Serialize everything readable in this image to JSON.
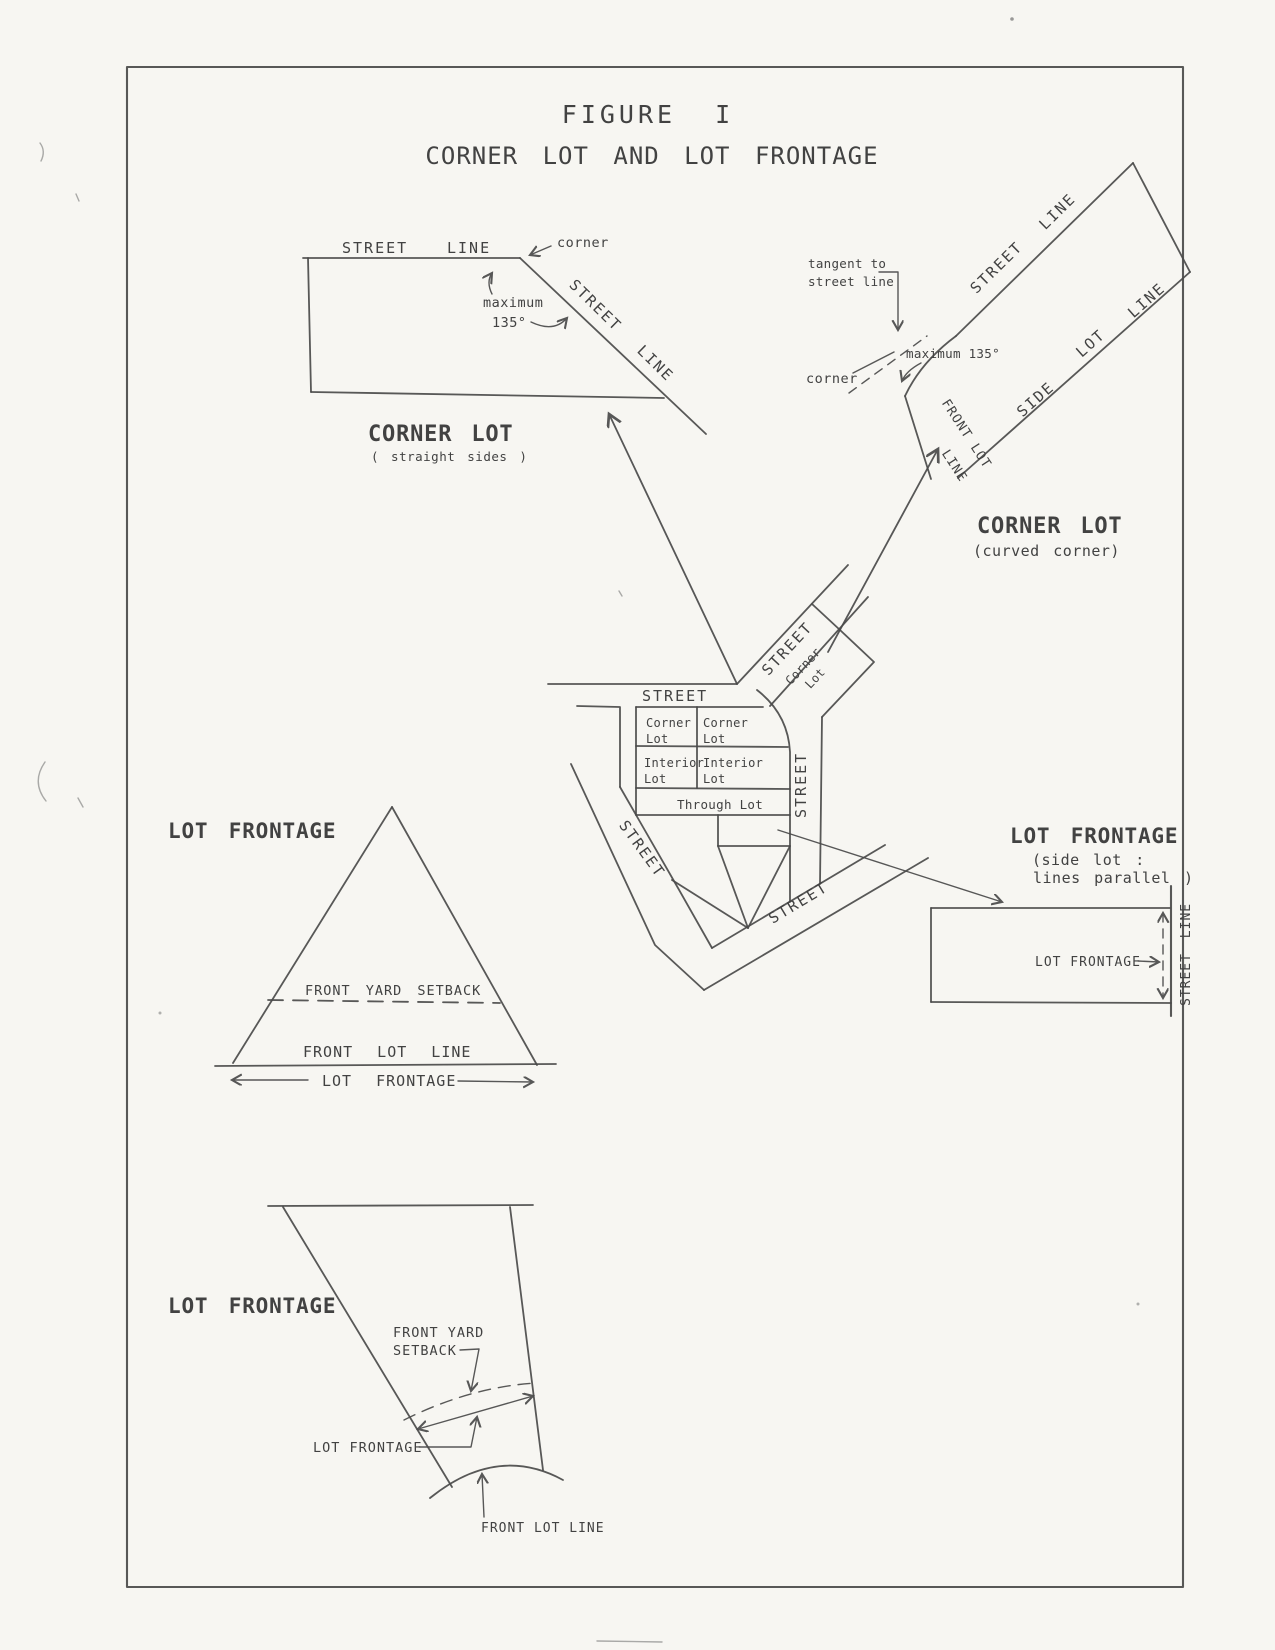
{
  "colors": {
    "ink": "#4a4a4a",
    "paper": "#f7f6f2"
  },
  "title": {
    "figure": "FIGURE I",
    "subtitle": "CORNER LOT AND LOT FRONTAGE"
  },
  "corner_lot_straight": {
    "street": "STREET",
    "line": "LINE",
    "corner": "corner",
    "maximum": "maximum",
    "angle": "135°",
    "street_diag": "STREET",
    "line_diag": "LINE",
    "title": "CORNER LOT",
    "subtitle": "( straight sides )"
  },
  "corner_lot_curved": {
    "tangent_line1": "tangent to",
    "tangent_line2": "street line",
    "street": "STREET",
    "line": "LINE",
    "maximum": "maximum 135°",
    "corner": "corner",
    "front_lot_row1": "FRONT LOT",
    "front_lot_row2": "LINE",
    "side": "SIDE",
    "lot": "LOT",
    "side_line": "LINE",
    "title": "CORNER LOT",
    "subtitle": "(curved corner)"
  },
  "block": {
    "street_top": "STREET",
    "street_diag": "STREET",
    "street_left": "STREET",
    "street_right": "STREET",
    "street_bottom": "STREET",
    "parcel": {
      "l1": "Corner",
      "l2": "Lot"
    },
    "cells": [
      {
        "l1": "Corner",
        "l2": "Lot"
      },
      {
        "l1": "Corner",
        "l2": "Lot"
      },
      {
        "l1": "Interior",
        "l2": "Lot"
      },
      {
        "l1": "Interior",
        "l2": "Lot"
      }
    ],
    "through": "Through Lot"
  },
  "triangle": {
    "title": "LOT FRONTAGE",
    "setback": "FRONT YARD SETBACK",
    "front_lot_line": "FRONT LOT LINE",
    "frontage": "LOT FRONTAGE"
  },
  "side_lot": {
    "title": "LOT FRONTAGE",
    "subtitle_line1": "(side lot :",
    "subtitle_line2": "lines parallel )",
    "frontage": "LOT FRONTAGE",
    "street_line": "STREET LINE"
  },
  "curved_street": {
    "title": "LOT FRONTAGE",
    "setback_line1": "FRONT YARD",
    "setback_line2": "SETBACK",
    "frontage": "LOT FRONTAGE",
    "front_lot_line": "FRONT LOT LINE"
  }
}
